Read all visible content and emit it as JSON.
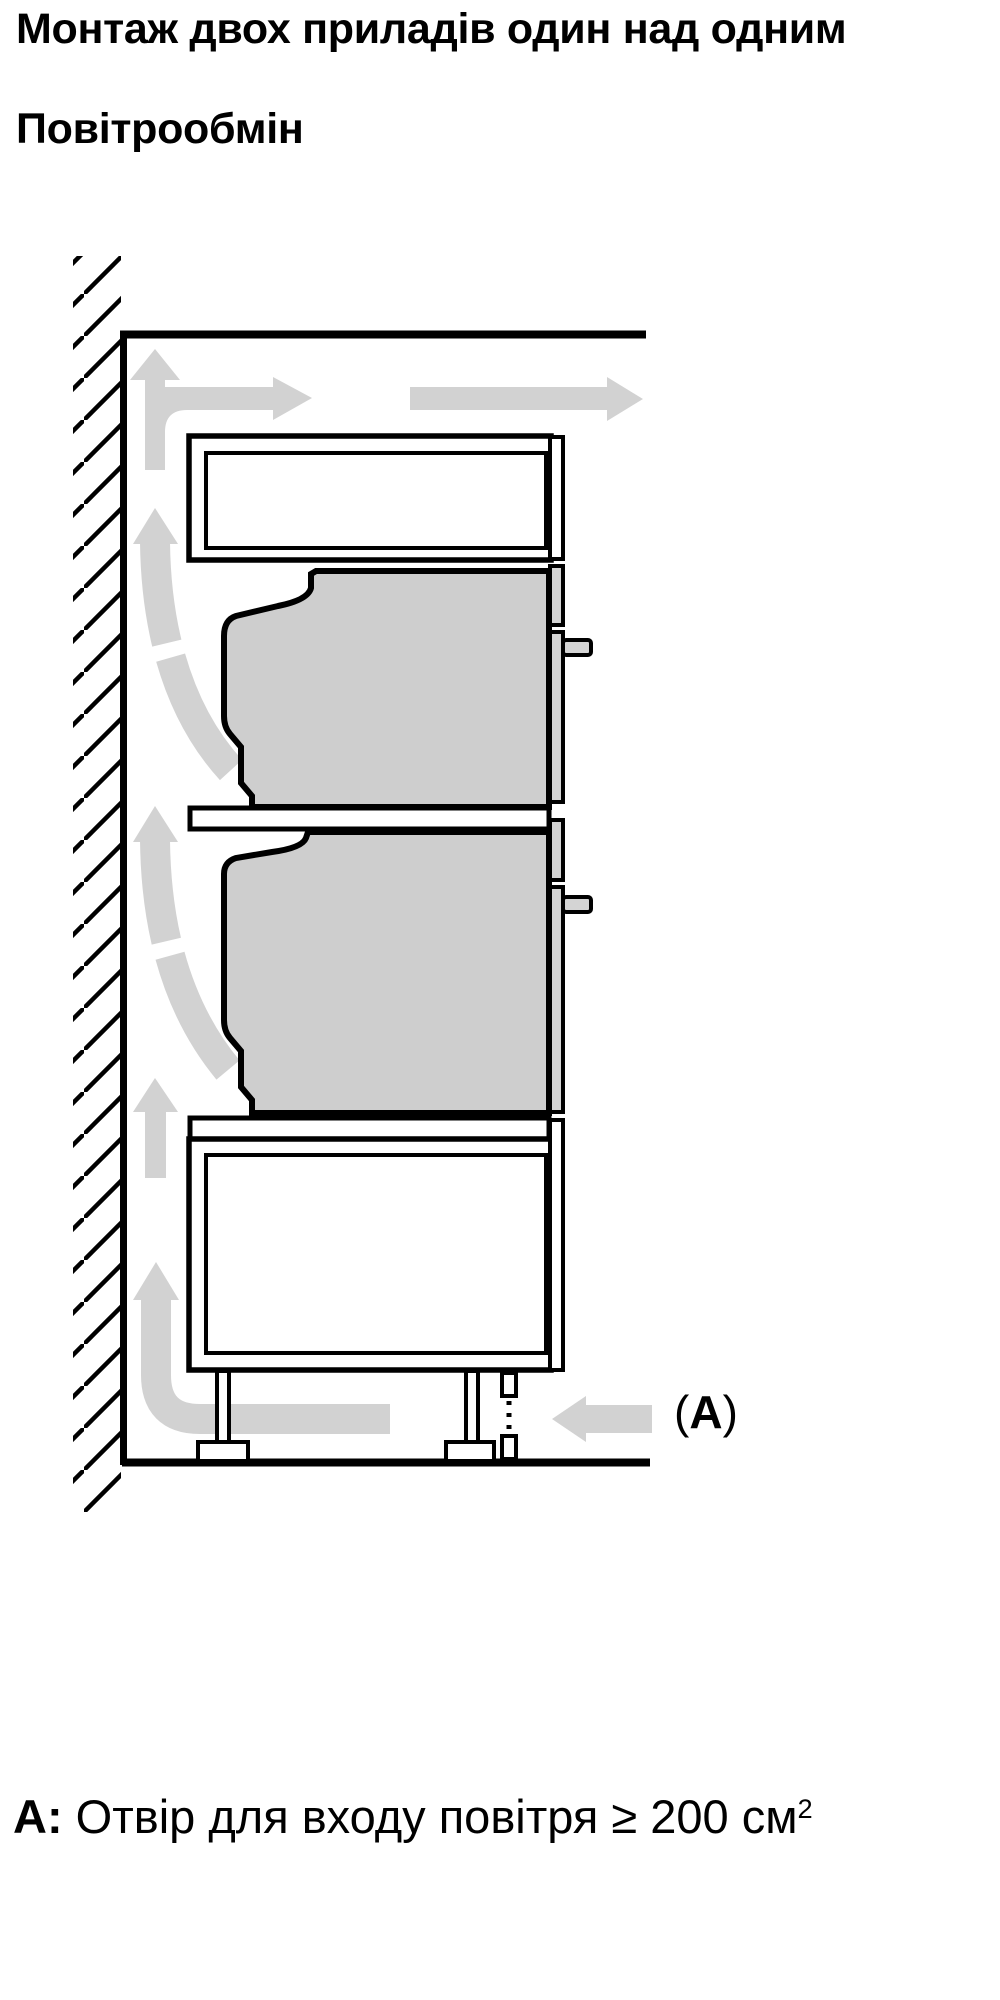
{
  "page": {
    "title_line1": "Монтаж двох приладів один над одним",
    "title_line2": "Повітрообмін"
  },
  "caption": {
    "label": "A:",
    "text": " Отвір для входу повітря ≥ 200 см",
    "superscript": "2"
  },
  "figure": {
    "annotation": {
      "open": "(",
      "letter": "A",
      "close": ")"
    },
    "colors": {
      "line": "#000000",
      "appliance_fill": "#cecece",
      "panel_fill": "#d4d4d4",
      "arrow_fill": "#d2d2d2",
      "background": "#ffffff"
    },
    "arrows": [
      {
        "name": "wall-channel-split-arrow",
        "direction": "up-then-right"
      },
      {
        "name": "ceiling-outflow-arrow",
        "direction": "right"
      },
      {
        "name": "upper-oven-back-airflow-arrow",
        "direction": "curved-up"
      },
      {
        "name": "lower-oven-back-airflow-arrow",
        "direction": "curved-up"
      },
      {
        "name": "base-cabinet-back-airflow-arrow",
        "direction": "up"
      },
      {
        "name": "floor-to-wall-airflow-arrow",
        "direction": "left-then-up"
      },
      {
        "name": "air-inlet-arrow",
        "direction": "left"
      }
    ]
  }
}
